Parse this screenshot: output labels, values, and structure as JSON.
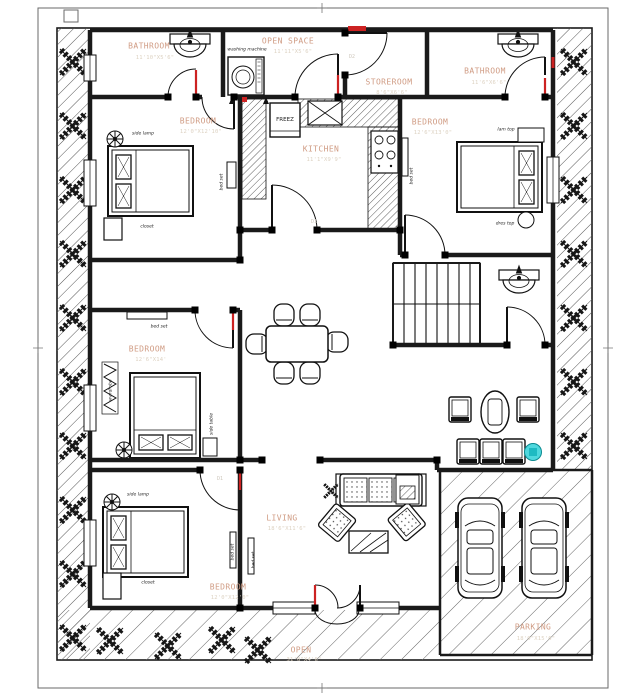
{
  "rooms": {
    "bathroom_tl": {
      "name": "BATHROOM",
      "dim": "11'10\"X5'6\""
    },
    "open_space": {
      "name": "OPEN SPACE",
      "dim": "11'11\"X5'6\""
    },
    "storeroom": {
      "name": "STOREROOM",
      "dim": "8'6\"X6'6\""
    },
    "bathroom_tr": {
      "name": "BATHROOM",
      "dim": "11'6\"X6'6\""
    },
    "bedroom_tl": {
      "name": "BEDROOM",
      "dim": "12'0\"X12'10\""
    },
    "kitchen": {
      "name": "KITCHEN",
      "dim": "11'1\"X9'9\""
    },
    "bedroom_tr": {
      "name": "BEDROOM",
      "dim": "12'6\"X13'0\""
    },
    "bedroom_ml": {
      "name": "BEDROOM",
      "dim": "12'6\"X14'"
    },
    "bedroom_bl": {
      "name": "BEDROOM",
      "dim": "12'0\"X12'0\""
    },
    "living": {
      "name": "LIVING",
      "dim": "18'6\"X11'6\""
    },
    "parking": {
      "name": "PARKING",
      "dim": "18'0\"X15'6\""
    },
    "open_bottom": {
      "name": "OPEN",
      "dim": "31'0\"X4'6\""
    }
  },
  "annotations": {
    "washing_machine": "washing machine",
    "freez": "FREEZ",
    "side_lamp": "side lamp",
    "closet": "closet",
    "bed_set": "bed set",
    "lam_top": "lam top",
    "dres_top": "dres top",
    "wardrobe": "wardrobe",
    "side_table": "side table",
    "d1": "D1",
    "d2": "D2"
  },
  "colors": {
    "line": "#1a1a1a",
    "room_label": "#d09c84",
    "dim_label": "#ddd2c2",
    "accent_red": "#cc2222",
    "accent_cyan": "#4fd8de"
  }
}
